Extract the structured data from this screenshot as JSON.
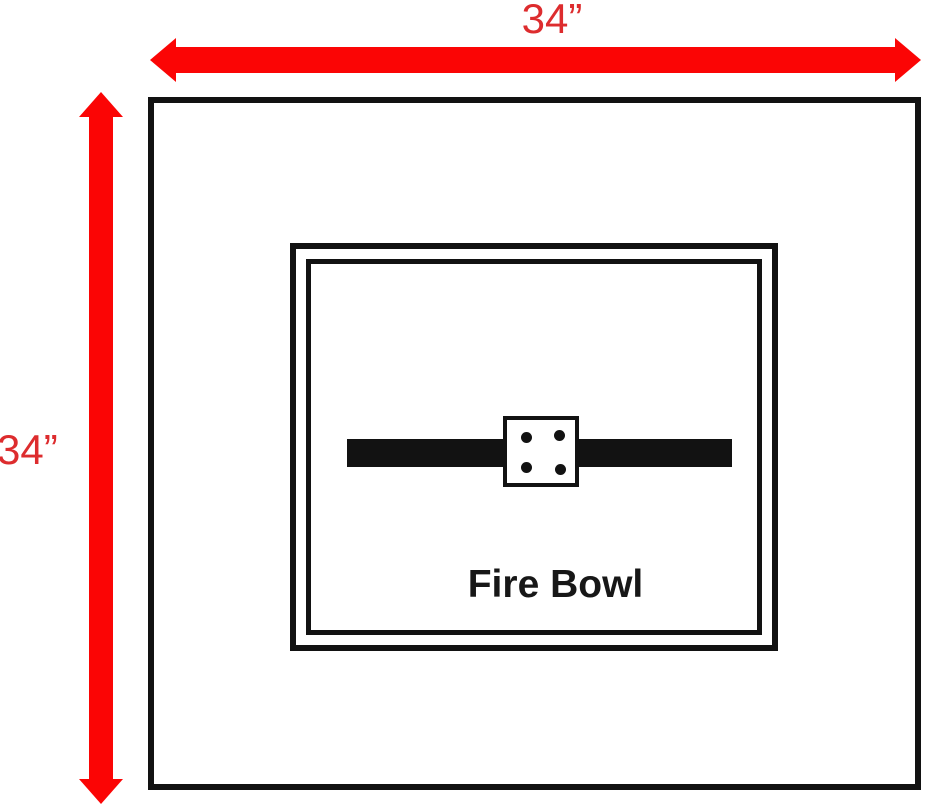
{
  "diagram": {
    "name": "fire-bowl-dimension-diagram",
    "top_dimension": {
      "label": "34”"
    },
    "left_dimension": {
      "label": "34”"
    },
    "fire_bowl": {
      "label": "Fire Bowl",
      "burner_dot_count": 4
    },
    "colors": {
      "arrow_red": "#fb0505",
      "dim_text_red": "#dd2c2e",
      "line_black": "#121212",
      "background": "#ffffff"
    }
  }
}
